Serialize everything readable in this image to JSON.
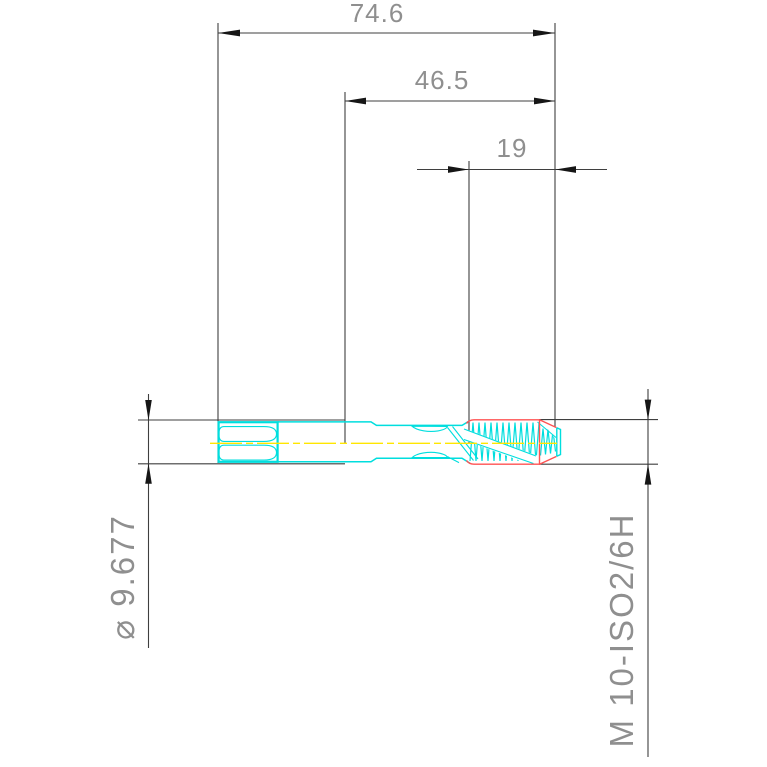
{
  "drawing": {
    "type": "cad-technical-drawing",
    "subject": "machine tap side view with dimensions",
    "dimensions": {
      "overall_length": "74.6",
      "length_to_neck": "46.5",
      "thread_length": "19",
      "diameter": "⌀ 9.677",
      "thread_designation": "M 10-ISO2/6H"
    },
    "colors": {
      "background": "#ffffff",
      "part_outline": "#00dede",
      "thread_limit": "#ff5252",
      "centerline": "#ffe600",
      "dimension_lines": "#3f3f3f",
      "arrowheads": "#161616",
      "dimension_text": "#8f8f8f"
    }
  }
}
